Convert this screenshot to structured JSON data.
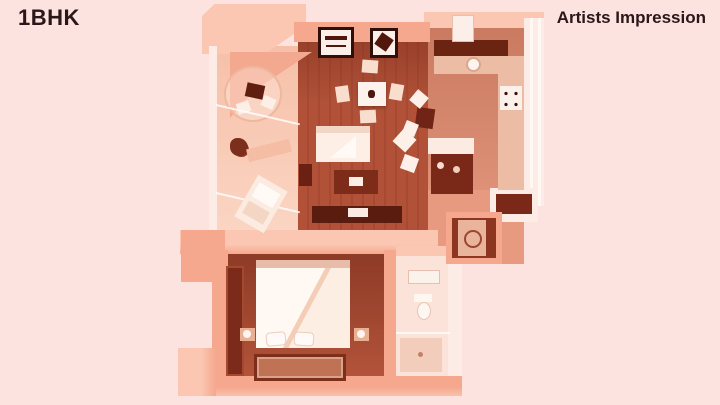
{
  "header": {
    "title": "1BHK",
    "watermark": "Artists Impression"
  },
  "colors": {
    "background": "#fce3df",
    "text": "#2b161a",
    "wall_top": "#fbc7b2",
    "wall_side": "#f5a88e",
    "wall_white": "#fdece6",
    "wood_floor": "#b05138",
    "bedroom_floor": "#a64934",
    "balcony_floor": "#f9cdb8",
    "kitchen_floor": "#dd8f78",
    "dark_furniture": "#6f2517",
    "white_furniture": "#fdf0e9"
  }
}
